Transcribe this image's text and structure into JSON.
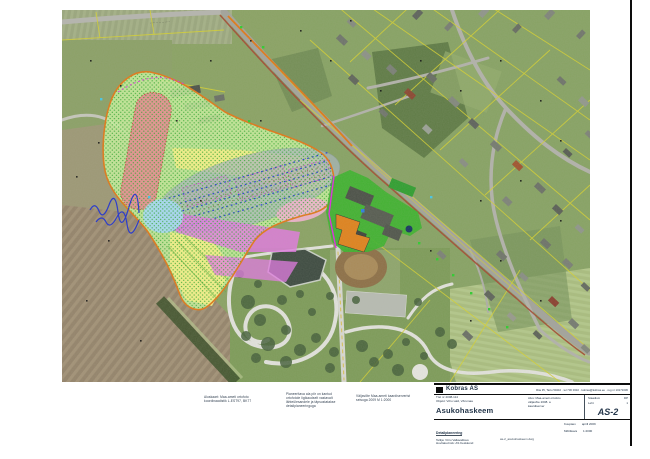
{
  "colors": {
    "planning_area": "#c9f19e",
    "red_zone": "#e59090",
    "yellow_zone": "#f6f186",
    "mound": "#a9b6bd",
    "magenta_zone": "#e678e6",
    "pink_zone": "#f3b3cf",
    "blue_zone": "#a6daf2",
    "facility_green": "#3cb32c",
    "building_orange": "#e0821c",
    "boundary_orange": "#e07818",
    "cadastral_yellow": "#d6d12f"
  },
  "map": {
    "road_label": "··············"
  },
  "notes": {
    "block1": {
      "line1": "Aluskaart: Maa-ameti ortofoto",
      "line2": "koordinaadistik L-EST97, BK77"
    },
    "block2": {
      "line1": "Planeeritava ala piir on kantud",
      "line2": "ortofotole ligikaudselt vastavalt",
      "line3": "lähteülesandele ja täpsustatakse",
      "line4": "detailplaneeringuga"
    },
    "block3": {
      "line1": "Väljavõte Maa-ameti kaardiserverist",
      "line2": "seisuga 2009      M 1:2000"
    }
  },
  "titleblock": {
    "company": "Kobras AS",
    "company_info": "Riia 35, Tartu 50410 · tel 730 0310 · kobras@kobras.ee · reg nr 10171636",
    "work_no": "Töö nr 2008-114",
    "object_line": "Objekt: Võru vald, Võrumaa",
    "title": "Asukohaskeem",
    "mid_line1": "Alus: Maa-ameti ortofoto",
    "mid_line2": "väljavõte 2008. a",
    "mid_line3": "kaardiserver",
    "stage_label": "Staadium",
    "stage_value": "DP",
    "sheet_label": "Leht",
    "sheet_value": "1",
    "drawing_no": "AS-2",
    "project_line": "Detailplaneering",
    "client_line": "Tellija: Võru Vallavalitsus",
    "extra_line": "Huvitatud isik: AS Keskkond",
    "file_line": "as-2_asukohaskeem.dwg",
    "date_label": "Kuupäev",
    "date_value": "aprill 2009",
    "scale_label": "Mõõtkava",
    "scale_value": "1:2000"
  }
}
